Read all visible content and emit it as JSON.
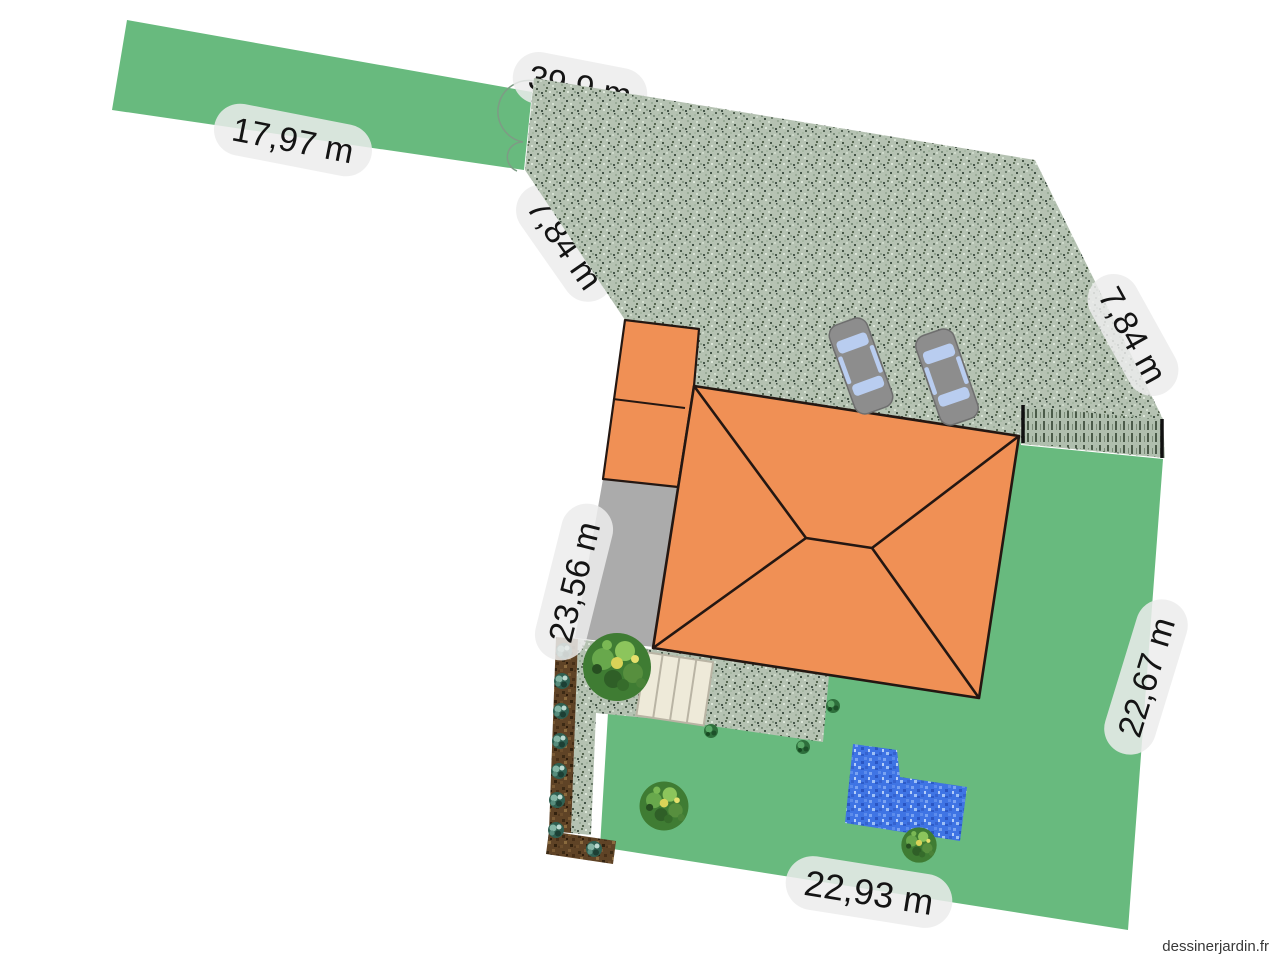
{
  "watermark": {
    "text": "dessinerjardin.fr"
  },
  "plan": {
    "unit": "m",
    "measurements": [
      {
        "id": "north-boundary",
        "text": "39,9 m"
      },
      {
        "id": "access-path-length",
        "text": "17,97 m"
      },
      {
        "id": "northwest-boundary",
        "text": "7,84 m"
      },
      {
        "id": "northeast-boundary",
        "text": "7,84 m"
      },
      {
        "id": "west-boundary",
        "text": "23,56 m"
      },
      {
        "id": "east-boundary",
        "text": "22,67 m"
      },
      {
        "id": "south-boundary",
        "text": "22,93 m"
      }
    ],
    "colors": {
      "lawn": "#68ba7e",
      "gravel": "#b5c2b2",
      "house": "#f09055",
      "patio": "#ababab",
      "soil": "#5f4326",
      "pool": "#3f74e4",
      "steps": "#eeead9",
      "label_bg": "#ececec",
      "label_text": "#141414"
    }
  }
}
